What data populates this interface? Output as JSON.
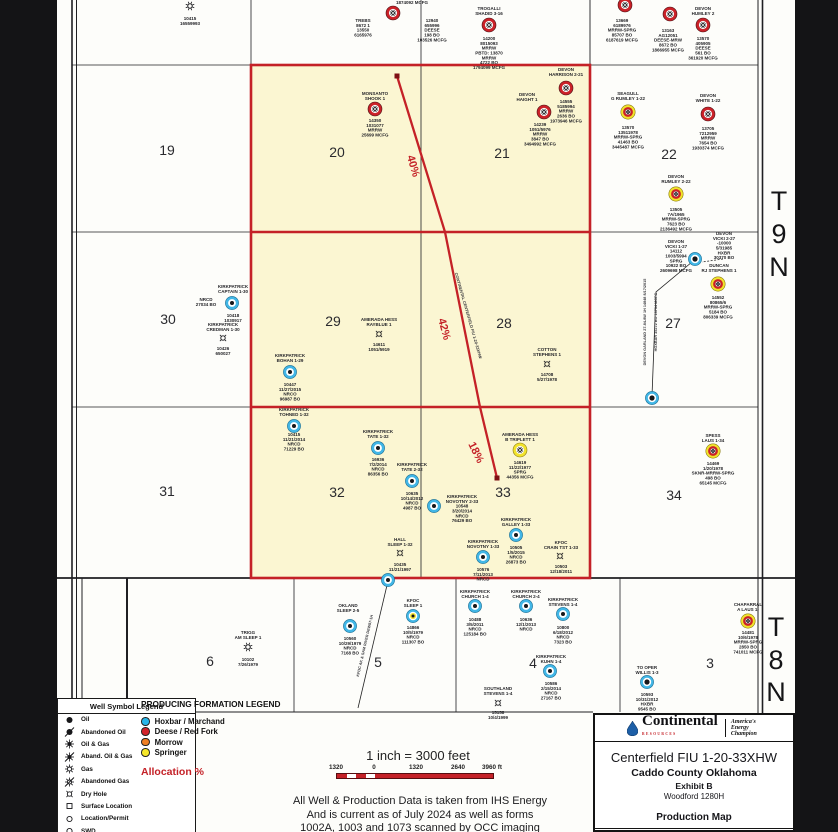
{
  "colors": {
    "red": "#c42127",
    "unit_fill": "#fbf6d2",
    "blue_well": "#41b6e6",
    "yellow_well": "#f2e32c",
    "orange": "#f07f23"
  },
  "township_labels": [
    {
      "ch": "T",
      "x": 779,
      "y": 210
    },
    {
      "ch": "9",
      "x": 779,
      "y": 243
    },
    {
      "ch": "N",
      "x": 779,
      "y": 276
    },
    {
      "ch": "T",
      "x": 776,
      "y": 636
    },
    {
      "ch": "8",
      "x": 776,
      "y": 669
    },
    {
      "ch": "N",
      "x": 776,
      "y": 701
    }
  ],
  "map": {
    "grid": {
      "v": [
        [
          72,
          0,
          712,
          1.6
        ],
        [
          76.5,
          0,
          712,
          1
        ],
        [
          251,
          0,
          578,
          0.8
        ],
        [
          421,
          0,
          578,
          0.8
        ],
        [
          590,
          0,
          578,
          0.9
        ],
        [
          82,
          578,
          700,
          1
        ],
        [
          127,
          578,
          698,
          2
        ],
        [
          294,
          578,
          712,
          0.8
        ],
        [
          456,
          578,
          712,
          0.8
        ],
        [
          620,
          578,
          712,
          0.8
        ],
        [
          758,
          0,
          832,
          1
        ],
        [
          762.5,
          0,
          832,
          1.6
        ]
      ],
      "h": [
        [
          65,
          72,
          758,
          0.8
        ],
        [
          232,
          72,
          758,
          0.8
        ],
        [
          407,
          72,
          758,
          0.8
        ],
        [
          578,
          57,
          795,
          1.8
        ],
        [
          712,
          196,
          593,
          0.9
        ]
      ]
    },
    "unit": {
      "x": 251,
      "y": 65,
      "w": 339,
      "h": 513,
      "rows": [
        232,
        407
      ]
    },
    "lateral": {
      "pts": [
        [
          397,
          76
        ],
        [
          445,
          232
        ],
        [
          480,
          407
        ],
        [
          497,
          478
        ]
      ],
      "squares": [
        [
          397,
          76
        ],
        [
          497,
          478
        ]
      ]
    },
    "lines": [
      {
        "pts": [
          [
            692,
            262
          ],
          [
            656,
            292
          ],
          [
            652,
            396
          ]
        ]
      },
      {
        "pts": [
          [
            388,
            581
          ],
          [
            358,
            708
          ]
        ]
      }
    ],
    "dashed": [
      {
        "pts": [
          [
            723,
            259
          ],
          [
            702,
            262
          ]
        ]
      }
    ],
    "wells": [
      {
        "x": 190,
        "y": 6,
        "t": "gas-sm"
      },
      {
        "x": 393,
        "y": 13,
        "t": "red-gas"
      },
      {
        "x": 489,
        "y": 25,
        "t": "red-gas"
      },
      {
        "x": 625,
        "y": 5,
        "t": "red-gas"
      },
      {
        "x": 670,
        "y": 14,
        "t": "red-gas"
      },
      {
        "x": 703,
        "y": 25,
        "t": "red-gas"
      },
      {
        "x": 375,
        "y": 109,
        "t": "red-gas"
      },
      {
        "x": 566,
        "y": 88,
        "t": "red-gas"
      },
      {
        "x": 544,
        "y": 112,
        "t": "red-gas"
      },
      {
        "x": 628,
        "y": 112,
        "t": "yellow-red-gas"
      },
      {
        "x": 708,
        "y": 114,
        "t": "red-gas"
      },
      {
        "x": 676,
        "y": 194,
        "t": "yellow-red-gas"
      },
      {
        "x": 232,
        "y": 303,
        "t": "blue"
      },
      {
        "x": 223,
        "y": 338,
        "t": "dry"
      },
      {
        "x": 290,
        "y": 372,
        "t": "blue"
      },
      {
        "x": 379,
        "y": 334,
        "t": "dry"
      },
      {
        "x": 547,
        "y": 364,
        "t": "dry"
      },
      {
        "x": 695,
        "y": 259,
        "t": "blue-dark"
      },
      {
        "x": 718,
        "y": 284,
        "t": "yellow-red-gas"
      },
      {
        "x": 652,
        "y": 398,
        "t": "blue-dark"
      },
      {
        "x": 294,
        "y": 426,
        "t": "blue"
      },
      {
        "x": 378,
        "y": 448,
        "t": "blue"
      },
      {
        "x": 412,
        "y": 481,
        "t": "blue"
      },
      {
        "x": 434,
        "y": 506,
        "t": "blue"
      },
      {
        "x": 520,
        "y": 450,
        "t": "yellow-gas"
      },
      {
        "x": 516,
        "y": 535,
        "t": "blue"
      },
      {
        "x": 483,
        "y": 557,
        "t": "blue"
      },
      {
        "x": 560,
        "y": 556,
        "t": "dry"
      },
      {
        "x": 713,
        "y": 451,
        "t": "yellow-red-gas"
      },
      {
        "x": 400,
        "y": 553,
        "t": "dry"
      },
      {
        "x": 388,
        "y": 580,
        "t": "blue"
      },
      {
        "x": 248,
        "y": 647,
        "t": "gas-sm"
      },
      {
        "x": 350,
        "y": 626,
        "t": "blue"
      },
      {
        "x": 413,
        "y": 616,
        "t": "blue-yellow"
      },
      {
        "x": 475,
        "y": 606,
        "t": "blue"
      },
      {
        "x": 526,
        "y": 606,
        "t": "blue"
      },
      {
        "x": 563,
        "y": 614,
        "t": "blue"
      },
      {
        "x": 550,
        "y": 671,
        "t": "blue"
      },
      {
        "x": 498,
        "y": 703,
        "t": "dry"
      },
      {
        "x": 647,
        "y": 682,
        "t": "blue-dark"
      },
      {
        "x": 748,
        "y": 621,
        "t": "yellow-red-gas"
      }
    ],
    "sections": [
      {
        "t": "19",
        "x": 167,
        "y": 155
      },
      {
        "t": "20",
        "x": 337,
        "y": 157
      },
      {
        "t": "21",
        "x": 502,
        "y": 158
      },
      {
        "t": "22",
        "x": 669,
        "y": 159
      },
      {
        "t": "30",
        "x": 168,
        "y": 324
      },
      {
        "t": "29",
        "x": 333,
        "y": 326
      },
      {
        "t": "28",
        "x": 504,
        "y": 328
      },
      {
        "t": "27",
        "x": 673,
        "y": 328
      },
      {
        "t": "31",
        "x": 167,
        "y": 496
      },
      {
        "t": "32",
        "x": 337,
        "y": 497
      },
      {
        "t": "33",
        "x": 503,
        "y": 497
      },
      {
        "t": "34",
        "x": 674,
        "y": 500
      },
      {
        "t": "6",
        "x": 210,
        "y": 666
      },
      {
        "t": "5",
        "x": 378,
        "y": 667
      },
      {
        "t": "4",
        "x": 533,
        "y": 668
      },
      {
        "t": "3",
        "x": 710,
        "y": 668
      }
    ],
    "alloc_labels": [
      {
        "t": "40%",
        "x": 410,
        "y": 167,
        "r": 74
      },
      {
        "t": "42%",
        "x": 441,
        "y": 330,
        "r": 75
      },
      {
        "t": "18%",
        "x": 473,
        "y": 454,
        "r": 64
      }
    ],
    "labels": [
      {
        "x": 190,
        "y": 20,
        "t": "10415\n16559993"
      },
      {
        "x": 412,
        "y": 4,
        "t": "1874092 MCFG"
      },
      {
        "x": 363,
        "y": 22,
        "t": "TREBS\n8672 1\n13550\n6165976"
      },
      {
        "x": 432,
        "y": 22,
        "t": "12940\n655996\nDEESE\n198 BO\n103526 MCFG"
      },
      {
        "x": 489,
        "y": 10,
        "t": "TROGALLI\nSHADID 3-16"
      },
      {
        "x": 489,
        "y": 40,
        "t": "14200\n8015093\nMRRW\nPBTD: 13870\nMRRW\n4722 BO\n1794099 MCFG"
      },
      {
        "x": 622,
        "y": 22,
        "t": "13669\n6189976\nMRRW-SPRG\n85707 BO\n6187619 MCFG"
      },
      {
        "x": 703,
        "y": 10,
        "t": "DEVON\nHUMLEY 2"
      },
      {
        "x": 703,
        "y": 40,
        "t": "13570\n405905\nDEESE\n561 BO\n361920 MCFG"
      },
      {
        "x": 668,
        "y": 32,
        "t": "13163\nAG12051\nDEESE-MRW\n8672 BO\n1866955 MCFG"
      },
      {
        "x": 375,
        "y": 95,
        "t": "MONSANTO\nSHOOK 1"
      },
      {
        "x": 375,
        "y": 122,
        "t": "14350\n1031077\nMRRW\n25699 MCFG"
      },
      {
        "x": 566,
        "y": 71,
        "t": "DEVON\nHARRISON 2-21"
      },
      {
        "x": 566,
        "y": 103,
        "t": "14555\n5185994\nMRRW\n2636 BO\n1973946 MCFG"
      },
      {
        "x": 527,
        "y": 96,
        "t": "DEVON\nHAIGHT 1"
      },
      {
        "x": 540,
        "y": 126,
        "t": "14239\n1051/5976\nMRRW\n3847 BO\n3494992 MCFG"
      },
      {
        "x": 628,
        "y": 95,
        "t": "SEAGULL\nG RUMLEY 1-22"
      },
      {
        "x": 628,
        "y": 129,
        "t": "13570\n13511978\nMRRW-SPRG\n41463 BO\n3445487 MCFG"
      },
      {
        "x": 708,
        "y": 97,
        "t": "DEVON\nWHITE 1-22"
      },
      {
        "x": 708,
        "y": 130,
        "t": "13705\n7212959\nMRRW\n7654 BO\n1930374 MCFG"
      },
      {
        "x": 676,
        "y": 178,
        "t": "DEVON\nRUMLEY 2-22"
      },
      {
        "x": 676,
        "y": 211,
        "t": "13505\n7A/1965\nMRRW-SPRG\n7623 BO\n2136492 MCFG"
      },
      {
        "x": 233,
        "y": 288,
        "t": "KIRKPATRICK\nCAPTAIN 1-30"
      },
      {
        "x": 206,
        "y": 301,
        "t": "NRCD\n27034 BO"
      },
      {
        "x": 233,
        "y": 317,
        "t": "10418\n1030917"
      },
      {
        "x": 223,
        "y": 326,
        "t": "KIRKPATRICK\nCREDMAN 1-30"
      },
      {
        "x": 223,
        "y": 350,
        "t": "10426\n650027"
      },
      {
        "x": 290,
        "y": 357,
        "t": "KIRKPATRICK\nBOHAN 1-29"
      },
      {
        "x": 290,
        "y": 386,
        "t": "10447\n11/27/2015\nNRCO\n96987 BO"
      },
      {
        "x": 379,
        "y": 321,
        "t": "AMERADA HESS\nRAYBLUE 1"
      },
      {
        "x": 379,
        "y": 346,
        "t": "14611\n1051/5919"
      },
      {
        "x": 547,
        "y": 351,
        "t": "COTTON\nSTEPHENS 1"
      },
      {
        "x": 547,
        "y": 376,
        "t": "14708\n5/27/1978"
      },
      {
        "x": 676,
        "y": 243,
        "t": "DEVON\nVICKI 1-27\n14112\n1003/5994\nSPRG\n10922 BO\n2609698 MCFG"
      },
      {
        "x": 724,
        "y": 235,
        "t": "DEVON\nVICKI 2-27\n-10000\n5/31985\nHXBR\n30370 BO"
      },
      {
        "x": 719,
        "y": 267,
        "t": "DUNCAN\nRJ STEPHENS 1"
      },
      {
        "x": 718,
        "y": 299,
        "t": "14552\n80865/6\nMRRW-SPRG\n5184 BO\n806339 MCFG"
      },
      {
        "x": 294,
        "y": 411,
        "t": "KIRKPATRICK\nTOHNED 1-32"
      },
      {
        "x": 294,
        "y": 436,
        "t": "10415\n11/21/2014\nNRCD\n71229 BO"
      },
      {
        "x": 378,
        "y": 433,
        "t": "KIRKPATRICK\nTATE 1-32"
      },
      {
        "x": 378,
        "y": 461,
        "t": "16936\n7/2/2014\nNRCD\n86356 BO"
      },
      {
        "x": 412,
        "y": 466,
        "t": "KIRKPATRICK\nTATE 2-32"
      },
      {
        "x": 412,
        "y": 495,
        "t": "10635\n10/14/2012\nNRCD\n4987 BO"
      },
      {
        "x": 462,
        "y": 498,
        "t": "KIRKPATRICK\nNOVOTNY 2-33\n10548\n3/20/2014\nNRCD\n76429 BO"
      },
      {
        "x": 520,
        "y": 436,
        "t": "AMERADA HESS\nB TRIPLETT 1"
      },
      {
        "x": 520,
        "y": 464,
        "t": "14619\n11/22/1977\nSPRG\n44356 MCFG"
      },
      {
        "x": 516,
        "y": 521,
        "t": "KIRKPATRICK\nGALLEY 1-33"
      },
      {
        "x": 516,
        "y": 549,
        "t": "10505\n1/5/2015\nNRCD\n26873 BO"
      },
      {
        "x": 483,
        "y": 543,
        "t": "KIRKPATRICK\nNOVOTNY 1-33"
      },
      {
        "x": 483,
        "y": 571,
        "t": "10576\n7/11/2013\nNRCD"
      },
      {
        "x": 561,
        "y": 544,
        "t": "KFOC\nCRAIN TST 1-33"
      },
      {
        "x": 561,
        "y": 568,
        "t": "10503\n12/18/2011"
      },
      {
        "x": 713,
        "y": 437,
        "t": "SPESS\nLAUS 1-34"
      },
      {
        "x": 713,
        "y": 465,
        "t": "14469\n1/20/1978\nSKNR-MRRW-SPRG\n498 BO\n65145 MCFG"
      },
      {
        "x": 400,
        "y": 541,
        "t": "HALL\nSLEEP 1-32"
      },
      {
        "x": 400,
        "y": 566,
        "t": "10435\n11/21/1997"
      },
      {
        "x": 248,
        "y": 634,
        "t": "TRIGG\nAM SLEEP 1"
      },
      {
        "x": 248,
        "y": 661,
        "t": "10102\n7/26/1979"
      },
      {
        "x": 348,
        "y": 607,
        "t": "OKLAND\nSLEEP 2-5"
      },
      {
        "x": 350,
        "y": 640,
        "t": "10560\n10/29/1979\nNRCD\n7168 BO"
      },
      {
        "x": 413,
        "y": 602,
        "t": "KFOC\nSLEEP 1"
      },
      {
        "x": 413,
        "y": 629,
        "t": "14866\n10/5/1979\nNRCD\n111307 BO"
      },
      {
        "x": 475,
        "y": 593,
        "t": "KIRKPATRICK\nCHURCH 1-4"
      },
      {
        "x": 475,
        "y": 621,
        "t": "10488\n3/5/2011\nNRCD\n125184 BO"
      },
      {
        "x": 526,
        "y": 593,
        "t": "KIRKPATRICK\nCHURCH 2-4"
      },
      {
        "x": 526,
        "y": 621,
        "t": "10636\n12/1/2013\nNRCD"
      },
      {
        "x": 563,
        "y": 601,
        "t": "KIRKPATRICK\nSTEVENS 1-4"
      },
      {
        "x": 563,
        "y": 629,
        "t": "10800\n6/18/2012\nNRCD\n7323 BO"
      },
      {
        "x": 551,
        "y": 658,
        "t": "KIRKPATRICK\nKUHN 1-4"
      },
      {
        "x": 551,
        "y": 685,
        "t": "10586\n2/15/2014\nNRCD\n27167 BO"
      },
      {
        "x": 498,
        "y": 690,
        "t": "SOUTHLAND\nSTEVENS 1-4"
      },
      {
        "x": 498,
        "y": 714,
        "t": "15158\n10/4/1999"
      },
      {
        "x": 647,
        "y": 669,
        "t": "TO OPER\nWILLIS 1-3"
      },
      {
        "x": 647,
        "y": 696,
        "t": "10593\n10/31/2012\nHXBR\n9545 BO"
      },
      {
        "x": 748,
        "y": 606,
        "t": "CHAPARRAL\nA LAUS 1-"
      },
      {
        "x": 748,
        "y": 634,
        "t": "14481\n10/6/1978\nMRRW-SPRG\n2850 BO\n741011 MCFG"
      },
      {
        "x": 467,
        "y": 316,
        "t": "CONTINENTAL CENTERFIELD FIU 1-20-33XHW",
        "r": 74,
        "s": 4,
        "c": "#3a3a3e",
        "w": 600
      },
      {
        "x": 646,
        "y": 322,
        "t": "DEVON GARLAND 27-84-8W 1H 14848 8/17/2015",
        "r": -90,
        "s": 3.8,
        "c": "#3a3a3e",
        "w": 600
      },
      {
        "x": 657,
        "y": 322,
        "t": "HOXBAR 35272 BO 13734 MCFG",
        "r": -90,
        "s": 3.8,
        "c": "#3a3a3e",
        "w": 600
      },
      {
        "x": 366,
        "y": 646,
        "t": "KFOC AK & SAM RIVER DEW07-1H",
        "r": -77,
        "s": 3.8,
        "c": "#3a3a3e",
        "w": 600
      }
    ]
  },
  "legend_wells": {
    "title": "Well Symbol Legend",
    "items": [
      {
        "sym": "oil",
        "label": "Oil"
      },
      {
        "sym": "ab-oil",
        "label": "Abandoned Oil"
      },
      {
        "sym": "oilgas",
        "label": "Oil & Gas"
      },
      {
        "sym": "ab-oilgas",
        "label": "Aband. Oil & Gas"
      },
      {
        "sym": "gas",
        "label": "Gas"
      },
      {
        "sym": "ab-gas",
        "label": "Abandoned Gas"
      },
      {
        "sym": "dry",
        "label": "Dry Hole"
      },
      {
        "sym": "surf",
        "label": "Surface Location"
      },
      {
        "sym": "loc",
        "label": "Location/Permit"
      },
      {
        "sym": "swd",
        "label": "SWD"
      }
    ]
  },
  "legend_formation": {
    "title": "PRODUCING FORMATION LEGEND",
    "items": [
      {
        "color": "#29b5e8",
        "label": "Hoxbar / Marchand"
      },
      {
        "color": "#d2232a",
        "label": "Deese / Red Fork"
      },
      {
        "color": "#f07f23",
        "label": "Morrow"
      },
      {
        "color": "#f5e72b",
        "label": "Springer"
      }
    ],
    "allocation": "Allocation %"
  },
  "scale": {
    "text": "1 inch = 3000 feet",
    "ticks": [
      "1320",
      "0",
      "1320",
      "2640",
      "3960 ft"
    ],
    "tick_x": [
      8,
      46,
      88,
      130,
      164
    ]
  },
  "disclaimer": [
    "All Well & Production Data is taken from IHS Energy",
    "And is current as of July 2024 as well as forms",
    "1002A, 1003 and 1073 scanned by OCC imaging"
  ],
  "title_block": {
    "brand": "Continental",
    "brand_sub": "RESOURCES",
    "tagline1": "America's",
    "tagline2": "Energy",
    "tagline3": "Champion",
    "title": "Centerfield FIU 1-20-33XHW",
    "county": "Caddo County Oklahoma",
    "exhibit": "Exhibit B",
    "formation": "Woodford 1280H",
    "map_type": "Production Map",
    "est": "Est TMD: 29,045' Est LL: 12,900'"
  }
}
